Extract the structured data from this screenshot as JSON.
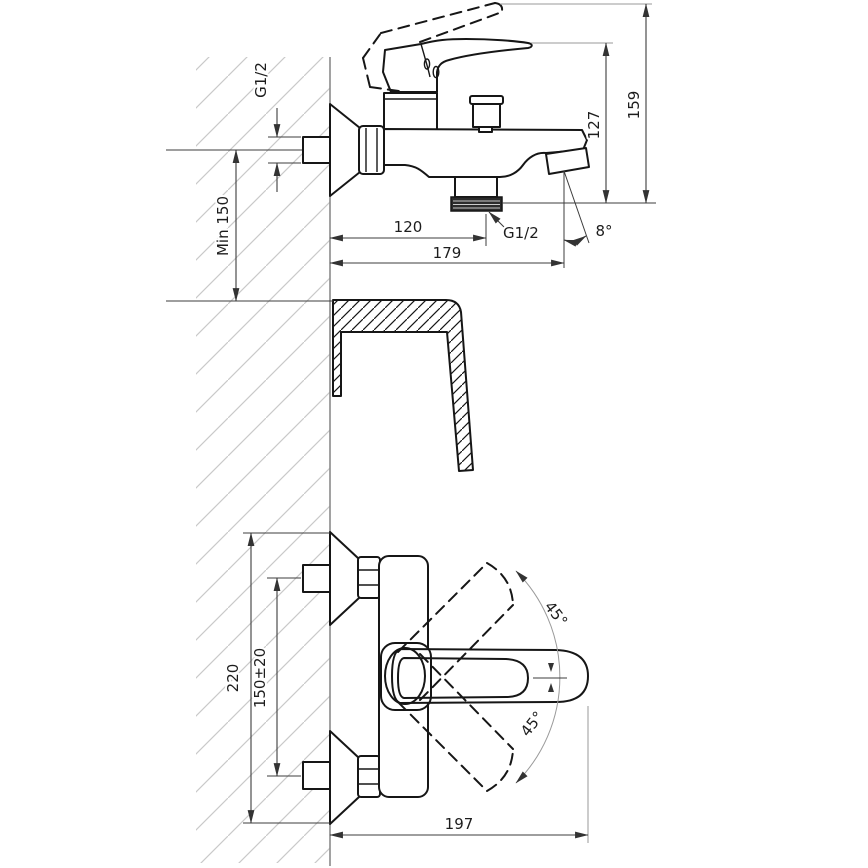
{
  "colors": {
    "line": "#161616",
    "dim": "#3c3c3c",
    "faint": "#9a9a9a",
    "wall": "#8a8a8a",
    "hatch": "#c9c9c9",
    "text": "#1d1d1d",
    "bg": "#ffffff"
  },
  "side_view": {
    "supply_thread": "G1/2",
    "min_mounting_height": "Min 150",
    "wall_to_outlet": "120",
    "wall_to_spout_tip": "179",
    "outlet_thread": "G1/2",
    "spout_angle": "8°",
    "outlet_to_handle_top": "127",
    "overall_height": "159"
  },
  "front_view": {
    "overall_height": "220",
    "supply_centers": "150±20",
    "handle_swing_up": "45°",
    "handle_swing_down": "45°",
    "overall_width": "197"
  }
}
